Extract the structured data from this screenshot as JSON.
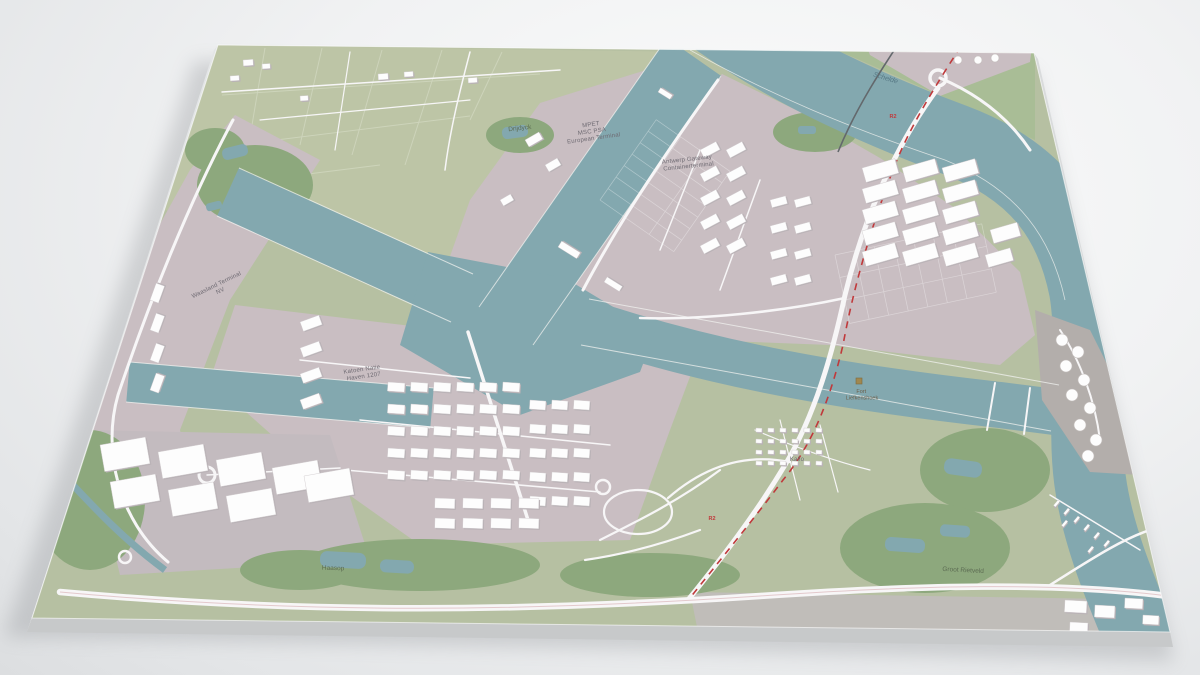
{
  "palette": {
    "background": "#f1f2f3",
    "slab_side_bottom": "#c7c9ca",
    "slab_side_left": "#e3e5e6",
    "slab_side_right": "#d9dbdc",
    "land": "#b6c0a2",
    "polder": "#bdc5a6",
    "vegetation": "#8da87d",
    "vegetation_dark": "#7f9c72",
    "water": "#83a8af",
    "industrial": "#c9bec2",
    "industrial_pad": "#c3bbbf",
    "road": "#f7f6f7",
    "building": "#fdfdfd",
    "building_shadow": "#b9b2b6",
    "tunnel_red": "#c0393b",
    "rail_gray": "#63686c",
    "label_gray": "#6e6a72",
    "label_green": "#5c6b52",
    "label_blue": "#567884",
    "label_fort": "#6d5f4b"
  },
  "labels": {
    "mpet": {
      "lines": [
        "MPET",
        "MSC PSA",
        "European Terminal"
      ]
    },
    "gateway": {
      "lines": [
        "Antwerp Gateway",
        "Containerterminal"
      ]
    },
    "terminal_nv": {
      "lines": [
        "Waasland Terminal",
        "NV"
      ]
    },
    "katoen": {
      "lines": [
        "Katoen Natie",
        "Haven 1207"
      ]
    },
    "drijdyck": {
      "lines": [
        "Drijdyck"
      ]
    },
    "schelde": {
      "lines": [
        "Schelde"
      ]
    },
    "fort": {
      "lines": [
        "Fort",
        "Liefkenshoek"
      ]
    },
    "rietveld": {
      "lines": [
        "Groot Rietveld"
      ]
    },
    "haasop": {
      "lines": [
        "Haasop"
      ]
    },
    "kallo": {
      "lines": [
        "Kallo"
      ]
    },
    "r2_north": {
      "text": "R2"
    },
    "r2_south": {
      "text": "R2"
    }
  }
}
